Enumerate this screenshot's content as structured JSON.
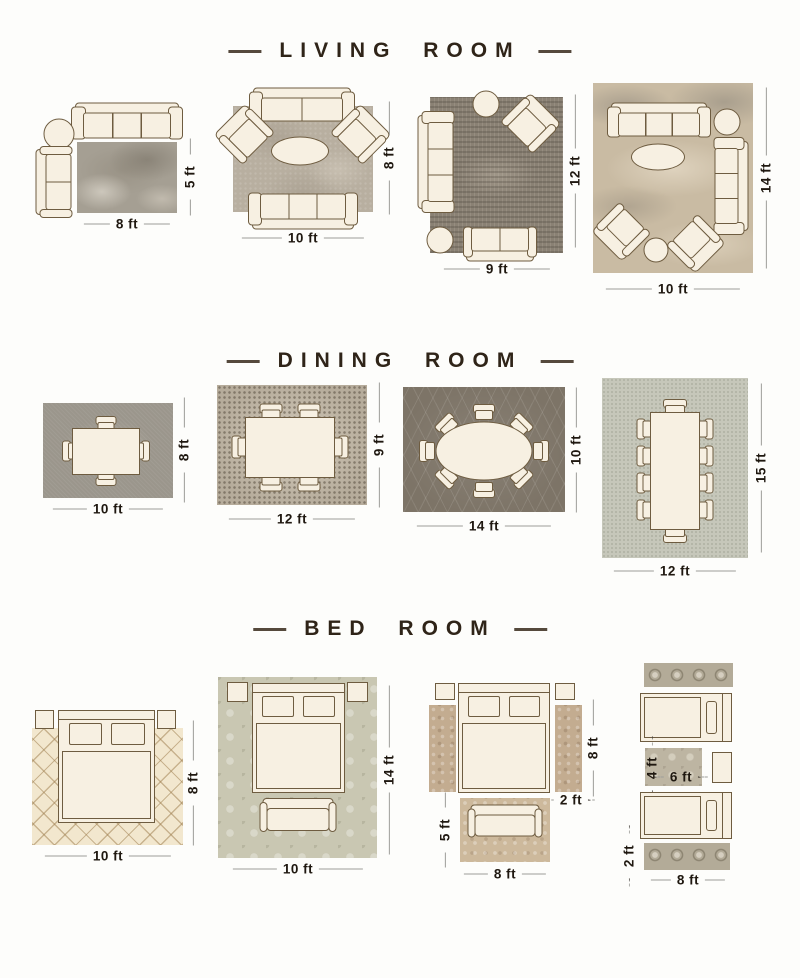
{
  "colors": {
    "title_text": "#2f2418",
    "dimension_text": "#1f1810",
    "dimension_line": "#9d9d99",
    "furniture_fill": "#f7f0e2",
    "furniture_outline": "#6e5c40",
    "living_rug_1": "#a59f93",
    "living_rug_2": "#b8afa0",
    "living_rug_3": "#8a8174",
    "living_rug_4": "#c9bba3",
    "dining_rug_1": "#9b968c",
    "dining_rug_2": "#b6ac9b",
    "dining_rug_3": "#7d7467",
    "dining_rug_4": "#c6c7ba",
    "bedroom_rug_1": "#f2e7ce",
    "bedroom_rug_2": "#c9c7b2",
    "bedroom_runner": "#c3ac90",
    "bedroom_ornate_runner": "#b3ab98"
  },
  "sections": [
    {
      "title": "LIVING ROOM",
      "layouts": [
        {
          "labels": {
            "bottom": "8 ft",
            "side": "5 ft"
          }
        },
        {
          "labels": {
            "bottom": "10 ft",
            "side": "8 ft"
          }
        },
        {
          "labels": {
            "bottom": "9 ft",
            "side": "12 ft"
          }
        },
        {
          "labels": {
            "bottom": "10 ft",
            "side": "14 ft"
          }
        }
      ]
    },
    {
      "title": "DINING ROOM",
      "layouts": [
        {
          "labels": {
            "bottom": "10 ft",
            "side": "8 ft"
          }
        },
        {
          "labels": {
            "bottom": "12 ft",
            "side": "9 ft"
          }
        },
        {
          "labels": {
            "bottom": "14 ft",
            "side": "10 ft"
          }
        },
        {
          "labels": {
            "bottom": "12 ft",
            "side": "15 ft"
          }
        }
      ]
    },
    {
      "title": "BED ROOM",
      "layouts": [
        {
          "labels": {
            "bottom": "10 ft",
            "side": "8 ft"
          }
        },
        {
          "labels": {
            "bottom": "10 ft",
            "side": "14 ft"
          }
        },
        {
          "labels": {
            "bottom": "8 ft",
            "side": "8 ft",
            "runner_width": "2 ft",
            "front_rug_side": "5 ft"
          }
        },
        {
          "labels": {
            "bottom": "8 ft",
            "middle_width": "6 ft",
            "middle_height": "4 ft",
            "runner_width": "2 ft"
          }
        }
      ]
    }
  ]
}
